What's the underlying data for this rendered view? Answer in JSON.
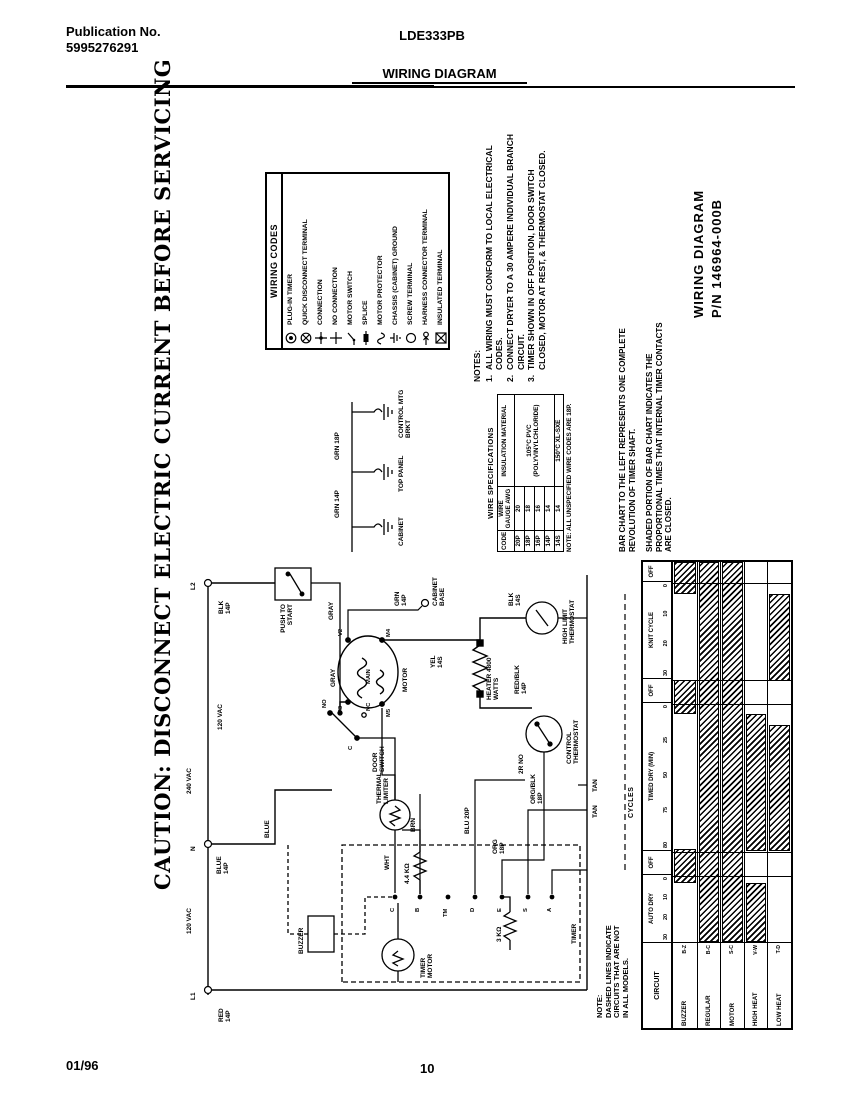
{
  "page": {
    "publication_label": "Publication No.",
    "publication_number": "5995276291",
    "model": "LDE333PB",
    "doc_title": "WIRING DIAGRAM",
    "footer_date": "01/96",
    "footer_page": "10"
  },
  "caution_title": "CAUTION: DISCONNECT ELECTRIC CURRENT BEFORE SERVICING",
  "part_number_block": {
    "line1": "WIRING DIAGRAM",
    "line2": "P/N 146964-000B"
  },
  "notes": {
    "title": "NOTES:",
    "items": [
      {
        "num": "1.",
        "text": "ALL WIRING MUST CONFORM TO LOCAL ELECTRICAL CODES."
      },
      {
        "num": "2.",
        "text": "CONNECT DRYER TO A 30 AMPERE INDIVIDUAL BRANCH CIRCUIT."
      },
      {
        "num": "3.",
        "text": "TIMER SHOWN IN OFF POSITION, DOOR SWITCH CLOSED, MOTOR AT REST, & THERMOSTAT CLOSED."
      }
    ]
  },
  "models_note": "NOTE:\nDASHED LINES INDICATE\nCIRCUITS THAT ARE NOT\nIN ALL MODELS.",
  "wiring_codes": {
    "title": "WIRING CODES",
    "items": [
      {
        "icon": "plug-in-timer",
        "label": "PLUG-IN TIMER"
      },
      {
        "icon": "quick-disconnect-terminal",
        "label": "QUICK DISCONNECT TERMINAL"
      },
      {
        "icon": "connection",
        "label": "CONNECTION"
      },
      {
        "icon": "no-connection",
        "label": "NO CONNECTION"
      },
      {
        "icon": "motor-switch",
        "label": "MOTOR SWITCH"
      },
      {
        "icon": "splice",
        "label": "SPLICE"
      },
      {
        "icon": "motor-protector",
        "label": "MOTOR PROTECTOR"
      },
      {
        "icon": "chassis-ground",
        "label": "CHASSIS (CABINET) GROUND"
      },
      {
        "icon": "screw-terminal",
        "label": "SCREW TERMINAL"
      },
      {
        "icon": "harness-connector-terminal",
        "label": "HARNESS CONNECTOR TERMINAL"
      },
      {
        "icon": "insulated-terminal",
        "label": "INSULATED TERMINAL"
      }
    ]
  },
  "wire_specs": {
    "title": "WIRE SPECIFICATIONS",
    "headers": [
      "CODE",
      "WIRE GAUGE AWG",
      "INSULATION MATERIAL"
    ],
    "rows": [
      {
        "code": "20P",
        "gauge": "20"
      },
      {
        "code": "18P",
        "gauge": "18"
      },
      {
        "code": "16P",
        "gauge": "16"
      },
      {
        "code": "14P",
        "gauge": "14"
      },
      {
        "code": "14S",
        "gauge": "14"
      }
    ],
    "insulation_pvc": "105°C PVC (POLYVINYLCHLORIDE)",
    "insulation_xl": "150°C XL-SXE",
    "note": "NOTE: ALL UNSPECIFIED WIRE CODES ARE 18P."
  },
  "bar_chart_caption": {
    "p1": "BAR CHART TO THE LEFT REPRESENTS ONE COMPLETE REVOLUTION OF TIMER SHAFT.",
    "p2": "SHADED PORTION OF BAR CHART INDICATES THE PROPORTIONAL TIMES THAT INTERNAL TIMER CONTACTS ARE CLOSED."
  },
  "chart_data": {
    "type": "bar",
    "title": "CYCLES",
    "row_header": "CIRCUIT",
    "legend_position": "right",
    "sections": [
      {
        "name": "AUTO DRY",
        "ticks": [
          "30",
          "20",
          "10",
          "0"
        ]
      },
      {
        "name": "OFF"
      },
      {
        "name": "TIMED DRY (MIN)",
        "ticks": [
          "80",
          "75",
          "50",
          "25",
          "0"
        ]
      },
      {
        "name": "OFF"
      },
      {
        "name": "KNIT CYCLE",
        "ticks": [
          "30",
          "20",
          "10",
          "0"
        ]
      },
      {
        "name": "OFF"
      }
    ],
    "rows": [
      {
        "circuit": "BUZZER",
        "contacts": "B-Z",
        "segments": [
          [
            0.155,
            0.245
          ],
          [
            0.6,
            0.69
          ],
          [
            0.915,
            1.0
          ]
        ]
      },
      {
        "circuit": "REGULAR",
        "contacts": "B-C",
        "segments": [
          [
            0.0,
            1.0
          ]
        ]
      },
      {
        "circuit": "MOTOR",
        "contacts": "S-C",
        "segments": [
          [
            0.0,
            1.0
          ]
        ]
      },
      {
        "circuit": "HIGH HEAT",
        "contacts": "V-W",
        "segments": [
          [
            0.0,
            0.155
          ],
          [
            0.239,
            0.6
          ]
        ]
      },
      {
        "circuit": "LOW HEAT",
        "contacts": "T-D",
        "segments": [
          [
            0.239,
            0.57
          ],
          [
            0.686,
            0.915
          ]
        ]
      }
    ]
  },
  "grounds": {
    "wires": [
      "GRN 14P",
      "GRN 18P"
    ],
    "labels": [
      "CABINET",
      "TOP PANEL",
      "CONTROL MTG BRKT"
    ]
  },
  "schematic": {
    "labels": {
      "l1": "L1",
      "l1_wire": "RED 14P",
      "n": "N",
      "n_wire": "BLUE 14P",
      "blue": "BLUE",
      "l2": "L2",
      "l2_wire": "BLK 14P",
      "vac240": "240 VAC",
      "vac120a": "120 VAC",
      "vac120b": "120 VAC",
      "push_to_start": "PUSH TO START",
      "gray1": "GRAY",
      "gray2": "GRAY",
      "door_switch": "DOOR SWITCH",
      "no": "NO",
      "nc": "NC",
      "c": "C",
      "motor": "MOTOR",
      "main": "MAIN",
      "m3": "M3",
      "m5": "M5",
      "m4": "M4",
      "v2": "V2",
      "grn_14p": "GRN 14P",
      "cabinet_base": "CABINET BASE",
      "thermal_limiter": "THERMAL LIMITER",
      "wht": "WHT",
      "timer_motor": "TIMER MOTOR",
      "res44": "4.4 KΩ",
      "res3": "3 KΩ",
      "buzzer": "BUZZER",
      "timer": "TIMER",
      "heater": "HEATER 4800 WATTS",
      "yel_14s": "YEL 14S",
      "blk_14s": "BLK 14S",
      "high_limit": "HIGH LIMIT THERMOSTAT",
      "red_blk": "RED/BLK 14P",
      "control_thermostat": "CONTROL THERMOSTAT",
      "org_blk": "ORG/BLK 18P",
      "r2no": "2R NO",
      "tan1": "TAN",
      "tan2": "TAN",
      "brn": "BRN",
      "blu_20p": "BLU 20P",
      "org_18p": "ORG 18P",
      "t_c": "C",
      "t_b": "B",
      "t_tm": "TM",
      "t_d": "D",
      "t_e": "E",
      "t_s": "S",
      "t_a": "A"
    }
  }
}
